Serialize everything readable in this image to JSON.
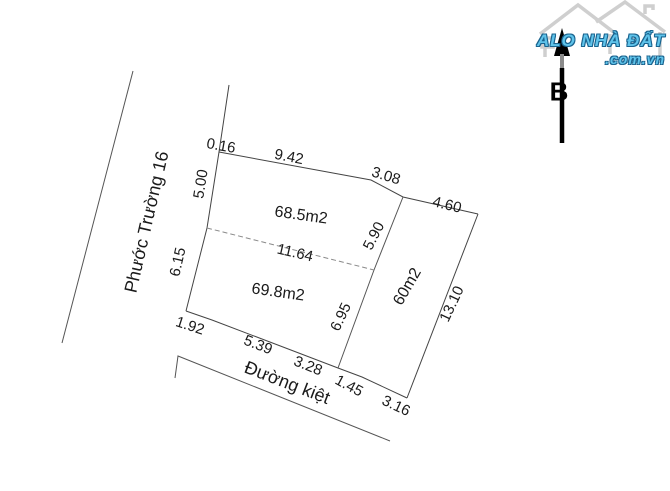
{
  "diagram": {
    "streets": {
      "left_road": "Phước Trường 16",
      "bottom_road": "Đường kiệt"
    },
    "compass": {
      "north_label": "B"
    },
    "parcels": {
      "top_parcel_area": "68.5m2",
      "bottom_parcel_area": "69.8m2",
      "right_parcel_area": "60m2"
    },
    "dimensions": {
      "top_0": "0.16",
      "top_1": "9.42",
      "top_2": "3.08",
      "top_3": "4.60",
      "left_0": "5.00",
      "left_1": "6.15",
      "inner_width": "11.64",
      "inner_right_0": "5.90",
      "inner_right_1": "6.95",
      "right_side": "13.10",
      "bottom_0": "1.92",
      "bottom_1": "5.39",
      "bottom_2": "3.28",
      "bottom_3": "1.45",
      "bottom_4": "3.16"
    }
  },
  "watermark": {
    "brand": "ALO NHÀ ĐẤT",
    "domain": ".com.vn",
    "brand_color": "#5fc3ea",
    "outline_color": "#1a648f",
    "house_color": "#cfcfcf"
  }
}
